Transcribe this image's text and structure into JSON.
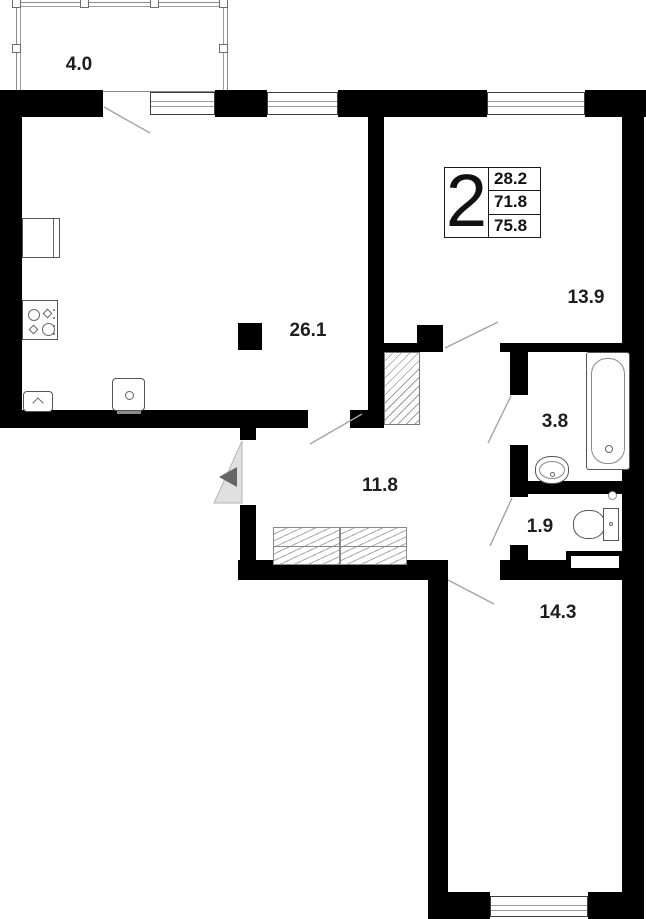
{
  "plan": {
    "badge": {
      "rooms": "2",
      "rows": [
        "28.2",
        "71.8",
        "75.8"
      ]
    },
    "rooms": {
      "balcony": {
        "label": "4.0"
      },
      "kitchen_living": {
        "label": "26.1"
      },
      "bedroom_1": {
        "label": "13.9"
      },
      "bathroom": {
        "label": "3.8"
      },
      "wc": {
        "label": "1.9"
      },
      "hallway": {
        "label": "11.8"
      },
      "bedroom_2": {
        "label": "14.3"
      }
    },
    "icons": [
      "fridge-icon",
      "stove-icon",
      "kitchen-sink-icon",
      "tv-icon",
      "wardrobe-icon",
      "bathtub-icon",
      "washbasin-icon",
      "toilet-icon",
      "vent-duct-icon",
      "ventilation-shaft-icon",
      "entrance-arrow-icon",
      "window-icon",
      "door-swing-icon"
    ],
    "colors": {
      "wall": "#000000",
      "fixture_line": "#555555",
      "swing_line": "#a3a3a3",
      "entrance_fill": "#e0e0e0",
      "entrance_arrow": "#666666"
    }
  }
}
